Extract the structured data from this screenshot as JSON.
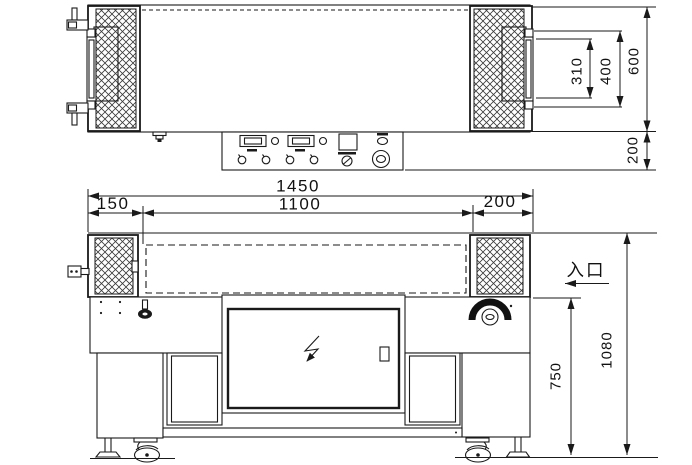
{
  "drawing": {
    "top_view": {
      "dimensions": {
        "roller_inner_width": "310",
        "roller_frame_width": "400",
        "body_width": "600",
        "control_panel_depth": "200"
      }
    },
    "front_view": {
      "dimensions": {
        "overall_length": "1450",
        "center_section_length": "1100",
        "left_section_length": "150",
        "right_section_length": "200",
        "table_height": "750",
        "overall_height": "1080"
      },
      "labels": {
        "entrance": "入口"
      }
    },
    "symbols": {
      "electrical_hazard": "lightning-arrow-icon"
    },
    "colors": {
      "line": "#1a1a1a",
      "background": "#ffffff"
    }
  }
}
